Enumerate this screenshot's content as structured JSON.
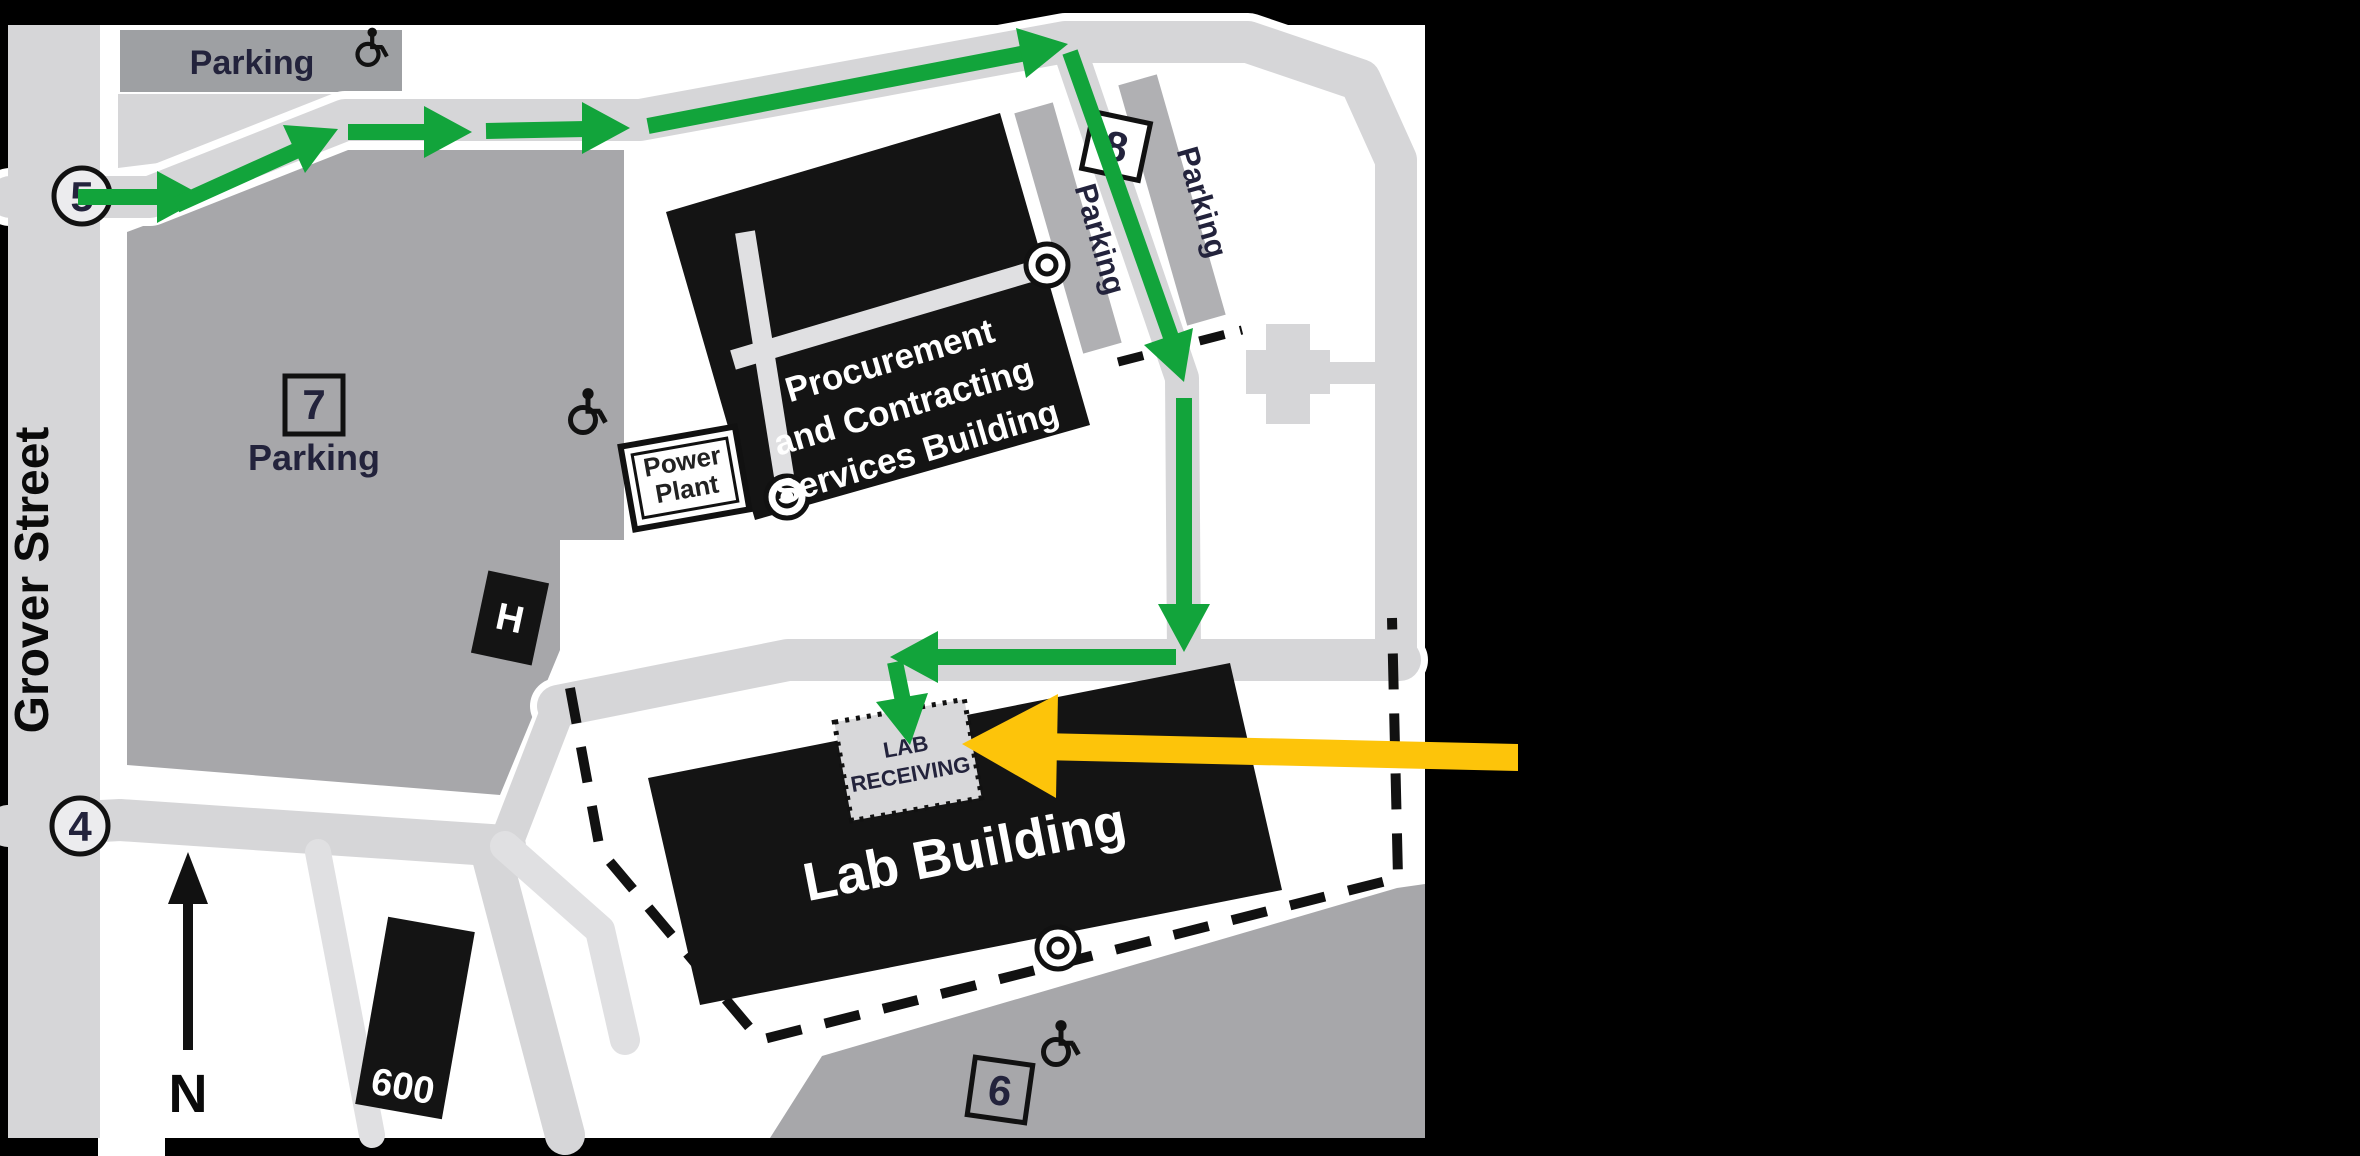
{
  "map": {
    "street_label": "Grover Street",
    "north_label": "N",
    "route_markers": {
      "start": "5",
      "south": "4"
    },
    "parking": {
      "top_strip_label": "Parking",
      "lot7_number": "7",
      "lot7_label": "Parking",
      "lot8_number": "8",
      "lot8_inner_label": "Parking",
      "lot8_outer_label": "Parking",
      "lot6_number": "6"
    },
    "buildings": {
      "procurement_line1": "Procurement",
      "procurement_line2": "and Contracting",
      "procurement_line3": "Services Building",
      "power_plant_line1": "Power",
      "power_plant_line2": "Plant",
      "lab_building_label": "Lab Building",
      "lab_receiving_line1": "LAB",
      "lab_receiving_line2": "RECEIVING",
      "h_building_label": "H",
      "building_600_label": "600"
    },
    "colors": {
      "route_green": "#12A43B",
      "highlight_yellow": "#FDC40A",
      "road": "#D6D6D8",
      "walkway": "#E0E0E2",
      "lot": "#A7A7AA",
      "strip": "#B0B0B3",
      "building": "#141414",
      "label": "#23233C",
      "map_bg": "#FFFFFF"
    }
  }
}
